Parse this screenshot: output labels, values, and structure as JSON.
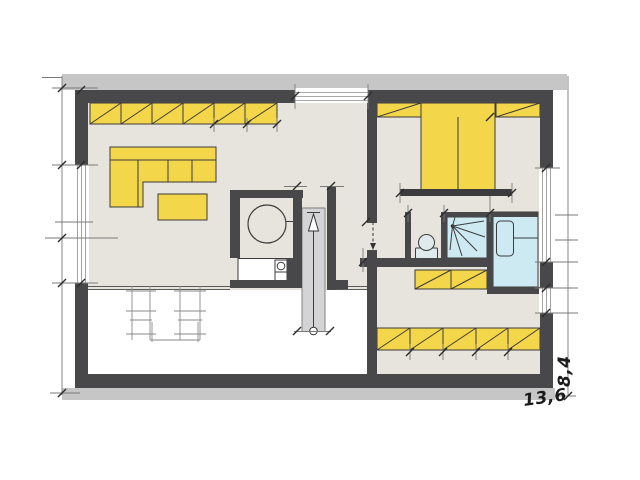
{
  "drawing": {
    "type": "architectural-floor-plan",
    "labels": {
      "bottom_width": "13,6",
      "right_height": "8,4"
    },
    "colors": {
      "wall": "#48484a",
      "band": "#c6c6c6",
      "floor": "#e7e4dd",
      "furniture": "#f3d649",
      "water": "#cdeaf2",
      "stair": "#d4d4d6",
      "fixture": "#dfeaec",
      "sketch": "#8a8a8a",
      "line": "#3c3c3c",
      "white": "#ffffff"
    },
    "elements": [
      "living-area",
      "hallway",
      "bedroom",
      "bathroom",
      "shower-room",
      "dressing-room",
      "open-void-area",
      "staircase-with-up-arrow",
      "wall-wardrobe-strips",
      "corner-sofa",
      "coffee-table",
      "double-bed",
      "round-shower",
      "washbasin-counter",
      "toilet",
      "shower-cabin",
      "bathtub-washstand",
      "sketched-dining-table-and-chairs",
      "windows",
      "dimension-lines"
    ]
  }
}
